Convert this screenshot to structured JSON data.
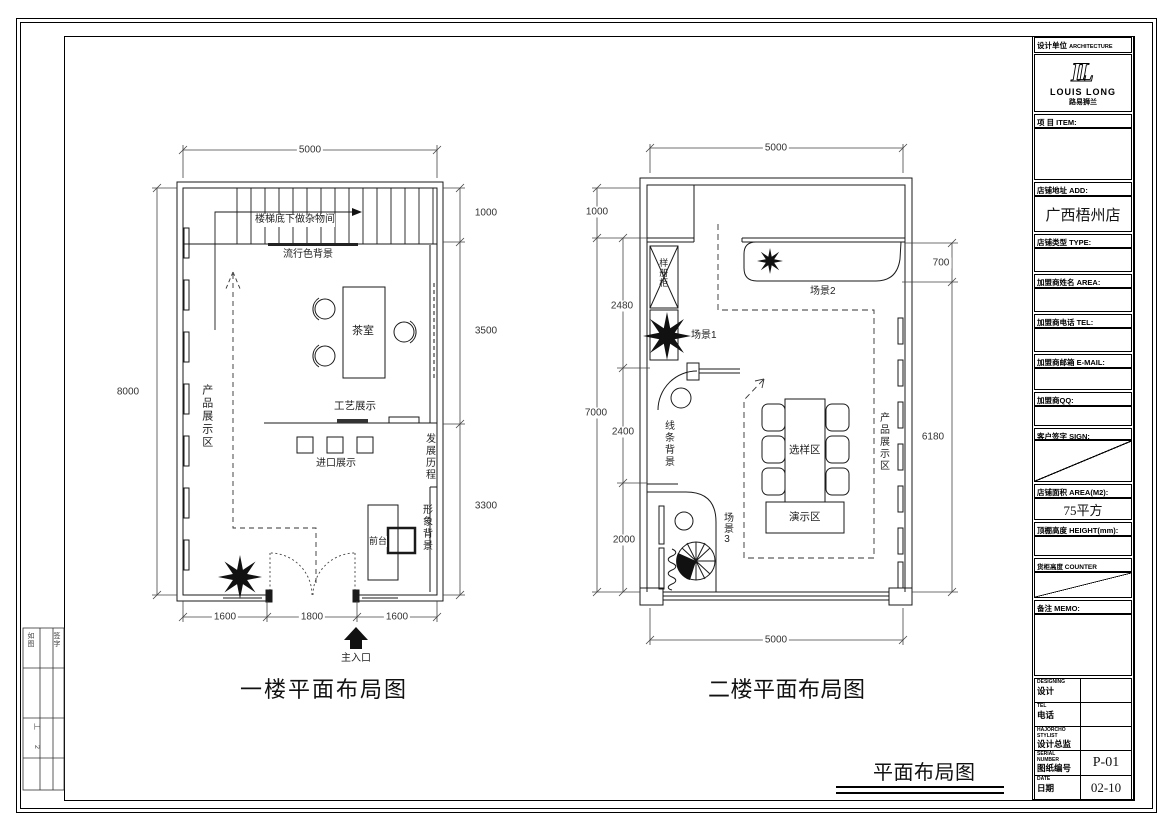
{
  "plan1": {
    "title": "一楼平面布局图",
    "dims": {
      "top": "5000",
      "left": "8000",
      "r1": "1000",
      "r2": "3500",
      "r3": "3300",
      "b1": "1600",
      "b2": "1800",
      "b3": "1600"
    },
    "labels": {
      "stair_note": "楼梯底下做杂物间",
      "trend": "流行色背景",
      "tea": "茶室",
      "craft": "工艺展示",
      "import": "进口展示",
      "history": "发展历程",
      "product": "产品展示区",
      "desk": "前台",
      "image_bg": "形象背景",
      "entrance": "主入口"
    }
  },
  "plan2": {
    "title": "二楼平面布局图",
    "dims": {
      "top": "5000",
      "l1": "1000",
      "l2": "2480",
      "l3": "7000",
      "l4": "2400",
      "l5": "2000",
      "r1": "700",
      "r2": "6180",
      "bottom": "5000"
    },
    "labels": {
      "cabinet": "样册柜",
      "scene1": "场景1",
      "scene2": "场景2",
      "scene3": "场景3",
      "line_bg": "线条背景",
      "select": "选样区",
      "demo": "演示区",
      "product": "产品展示区"
    }
  },
  "sheet": {
    "title": "平面布局图"
  },
  "titleblock": {
    "design_unit": "设计单位",
    "design_unit_en": "ARCHITECTURE DESIGN",
    "brand": "LOUIS LONG",
    "brand_cn": "路易狮兰",
    "item": "项  目  ITEM:",
    "addr": "店铺地址  ADD:",
    "addr_value": "广西梧州店",
    "type": "店铺类型  TYPE:",
    "name": "加盟商姓名  AREA:",
    "tel": "加盟商电话  TEL:",
    "email": "加盟商邮箱  E-MAIL:",
    "qq": "加盟商QQ:",
    "sign": "客户签字  SIGN:",
    "area": "店铺面积  AREA(M2):",
    "area_value": "75平方",
    "ceiling": "顶棚高度  HEIGHT(mm):",
    "counter": "货柜高度  COUNTER HEIGHT(mm):",
    "memo": "备注  MEMO:",
    "rows": [
      {
        "en": "DESIGNING",
        "cn": "设计",
        "val": ""
      },
      {
        "en": "TEL",
        "cn": "电话",
        "val": ""
      },
      {
        "en": "HAJORCHO STYLIST",
        "cn": "设计总监",
        "val": ""
      },
      {
        "en": "SERIAL NUMBER",
        "cn": "图纸编号",
        "val": "P-01"
      },
      {
        "en": "DATE",
        "cn": "日期",
        "val": "02-10"
      }
    ]
  },
  "side_strip": {
    "c1": "如图",
    "c2": "签字",
    "c3": "工",
    "c4": "2"
  }
}
